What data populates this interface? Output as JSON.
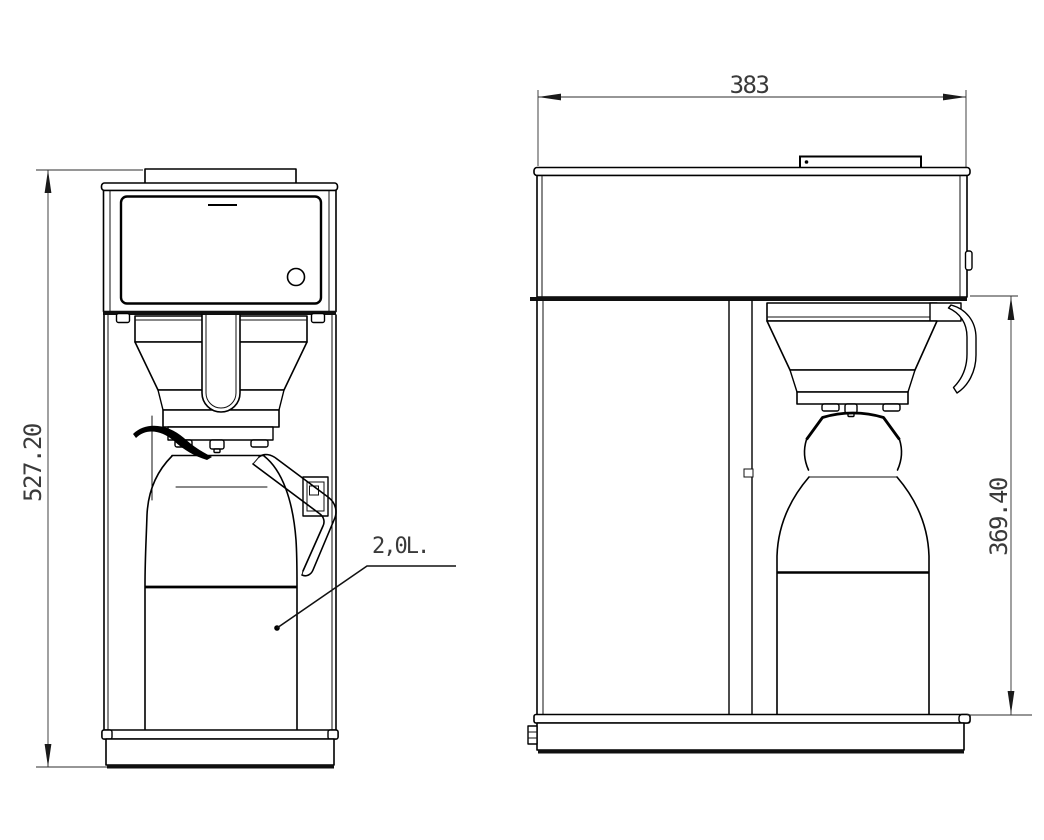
{
  "drawing": {
    "type": "technical-dimension-drawing",
    "subject": "pourover coffee brewer with 2.0 L thermos jug, front view and side view",
    "views": {
      "front": {
        "name": "front-view",
        "overall_height_dim": "527.20",
        "capacity_label": "2,0L."
      },
      "side": {
        "name": "side-view",
        "overall_depth_dim": "383",
        "clearance_height_dim": "369.40"
      }
    },
    "colors": {
      "background": "#ffffff",
      "outline": "#000000",
      "dimension_line": "#2e2e2e",
      "dimension_text": "#3a3a3a"
    }
  }
}
